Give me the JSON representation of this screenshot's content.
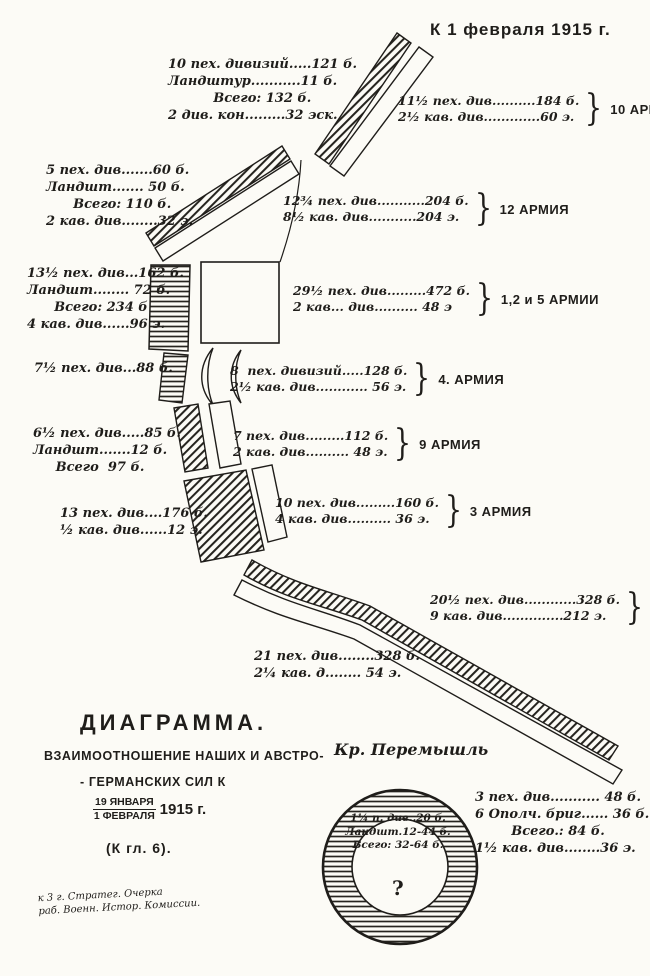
{
  "colors": {
    "paper": "#fcfbf6",
    "ink": "#1f1d1a"
  },
  "header": {
    "date_note": "К 1 февраля 1915 г."
  },
  "glyphs": {
    "brace": "}",
    "question": "?"
  },
  "german_blocks": [
    {
      "id": "nw-group",
      "lines": [
        "10 пех. дивизий.....121 б.",
        "Ландштур...........11 б.",
        "          Всего: 132 б.",
        "2 див. кон.........32 эск."
      ]
    },
    {
      "id": "w-group-1",
      "lines": [
        "5 пех. див.......60 б.",
        "Ландшт....... 50 б.",
        "      Всего: 110 б.",
        "2 кав. див........32 э."
      ]
    },
    {
      "id": "w-group-2",
      "lines": [
        "13½ пех. див...162 б.",
        "Ландшт........ 72 б.",
        "      Всего: 234 б",
        "4 кав. див......96 э."
      ]
    },
    {
      "id": "w-group-3",
      "lines": [
        "7½ пех. див...88 б."
      ]
    },
    {
      "id": "w-group-4",
      "lines": [
        "6½ пех. див.....85 б.",
        "Ландшт.......12 б.",
        "     Всего  97 б."
      ]
    },
    {
      "id": "w-group-5",
      "lines": [
        "13 пех. див....176 б.",
        "½ кав. див......12 э."
      ]
    },
    {
      "id": "s-group-6",
      "lines": [
        "21 пех. див........328 б.",
        "2¼ кав. д........ 54 э."
      ]
    },
    {
      "id": "fortress-besiegers",
      "lines": [
        "3 пех. див........... 48 б.",
        "6 Ополч. бриг...... 36 б.",
        "        Всего.: 84 б.",
        "1½ кав. див........36 э."
      ]
    }
  ],
  "russian_armies": [
    {
      "army": "10 АРМИЯ",
      "lines": [
        "11½ пех. див..........184 б.",
        "2½ кав. див.............60 э."
      ]
    },
    {
      "army": "12 АРМИЯ",
      "lines": [
        "12¾ пех. див...........204 б.",
        "8½ кав. див...........204 э."
      ]
    },
    {
      "army": "1,2 и 5 АРМИИ",
      "lines": [
        "29½ пех. див.........472 б.",
        "2 кав... див.......... 48 э"
      ]
    },
    {
      "army": "4. АРМИЯ",
      "lines": [
        "8  пех. дивизий.....128 б.",
        "2½ кав. див............ 56 э."
      ]
    },
    {
      "army": "9 АРМИЯ",
      "lines": [
        "7 пех. див.........112 б.",
        "2 кав. див.......... 48 э."
      ]
    },
    {
      "army": "3 АРМИЯ",
      "lines": [
        "10 пех. див.........160 б.",
        "4 кав. див.......... 36 э."
      ]
    },
    {
      "army": "8 АРМИЯ",
      "lines": [
        "20½ пех. див............328 б.",
        "9 кав. див..............212 э."
      ]
    }
  ],
  "legend": {
    "title": "ДИАГРАММА.",
    "subtitle1": "ВЗАИМООТНОШЕНИЕ  НАШИХ И АВСТРО-",
    "subtitle2": "- ГЕРМАНСКИХ  СИЛ  К",
    "date_top": "19 ЯНВАРЯ",
    "date_bottom": "1 ФЕВРАЛЯ",
    "date_year": "1915 г.",
    "ref": "(К гл. 6)."
  },
  "fortress": {
    "title": "Кр. Перемышль",
    "garrison_lines": [
      "1¼ п. див..20 б.",
      "Ландшт.12-44 б.",
      "Всего: 32-64 б."
    ]
  },
  "credit": {
    "line1": "к 3 г. Стратег. Очерка",
    "line2": "раб. Военн. Истор. Комиссии."
  }
}
